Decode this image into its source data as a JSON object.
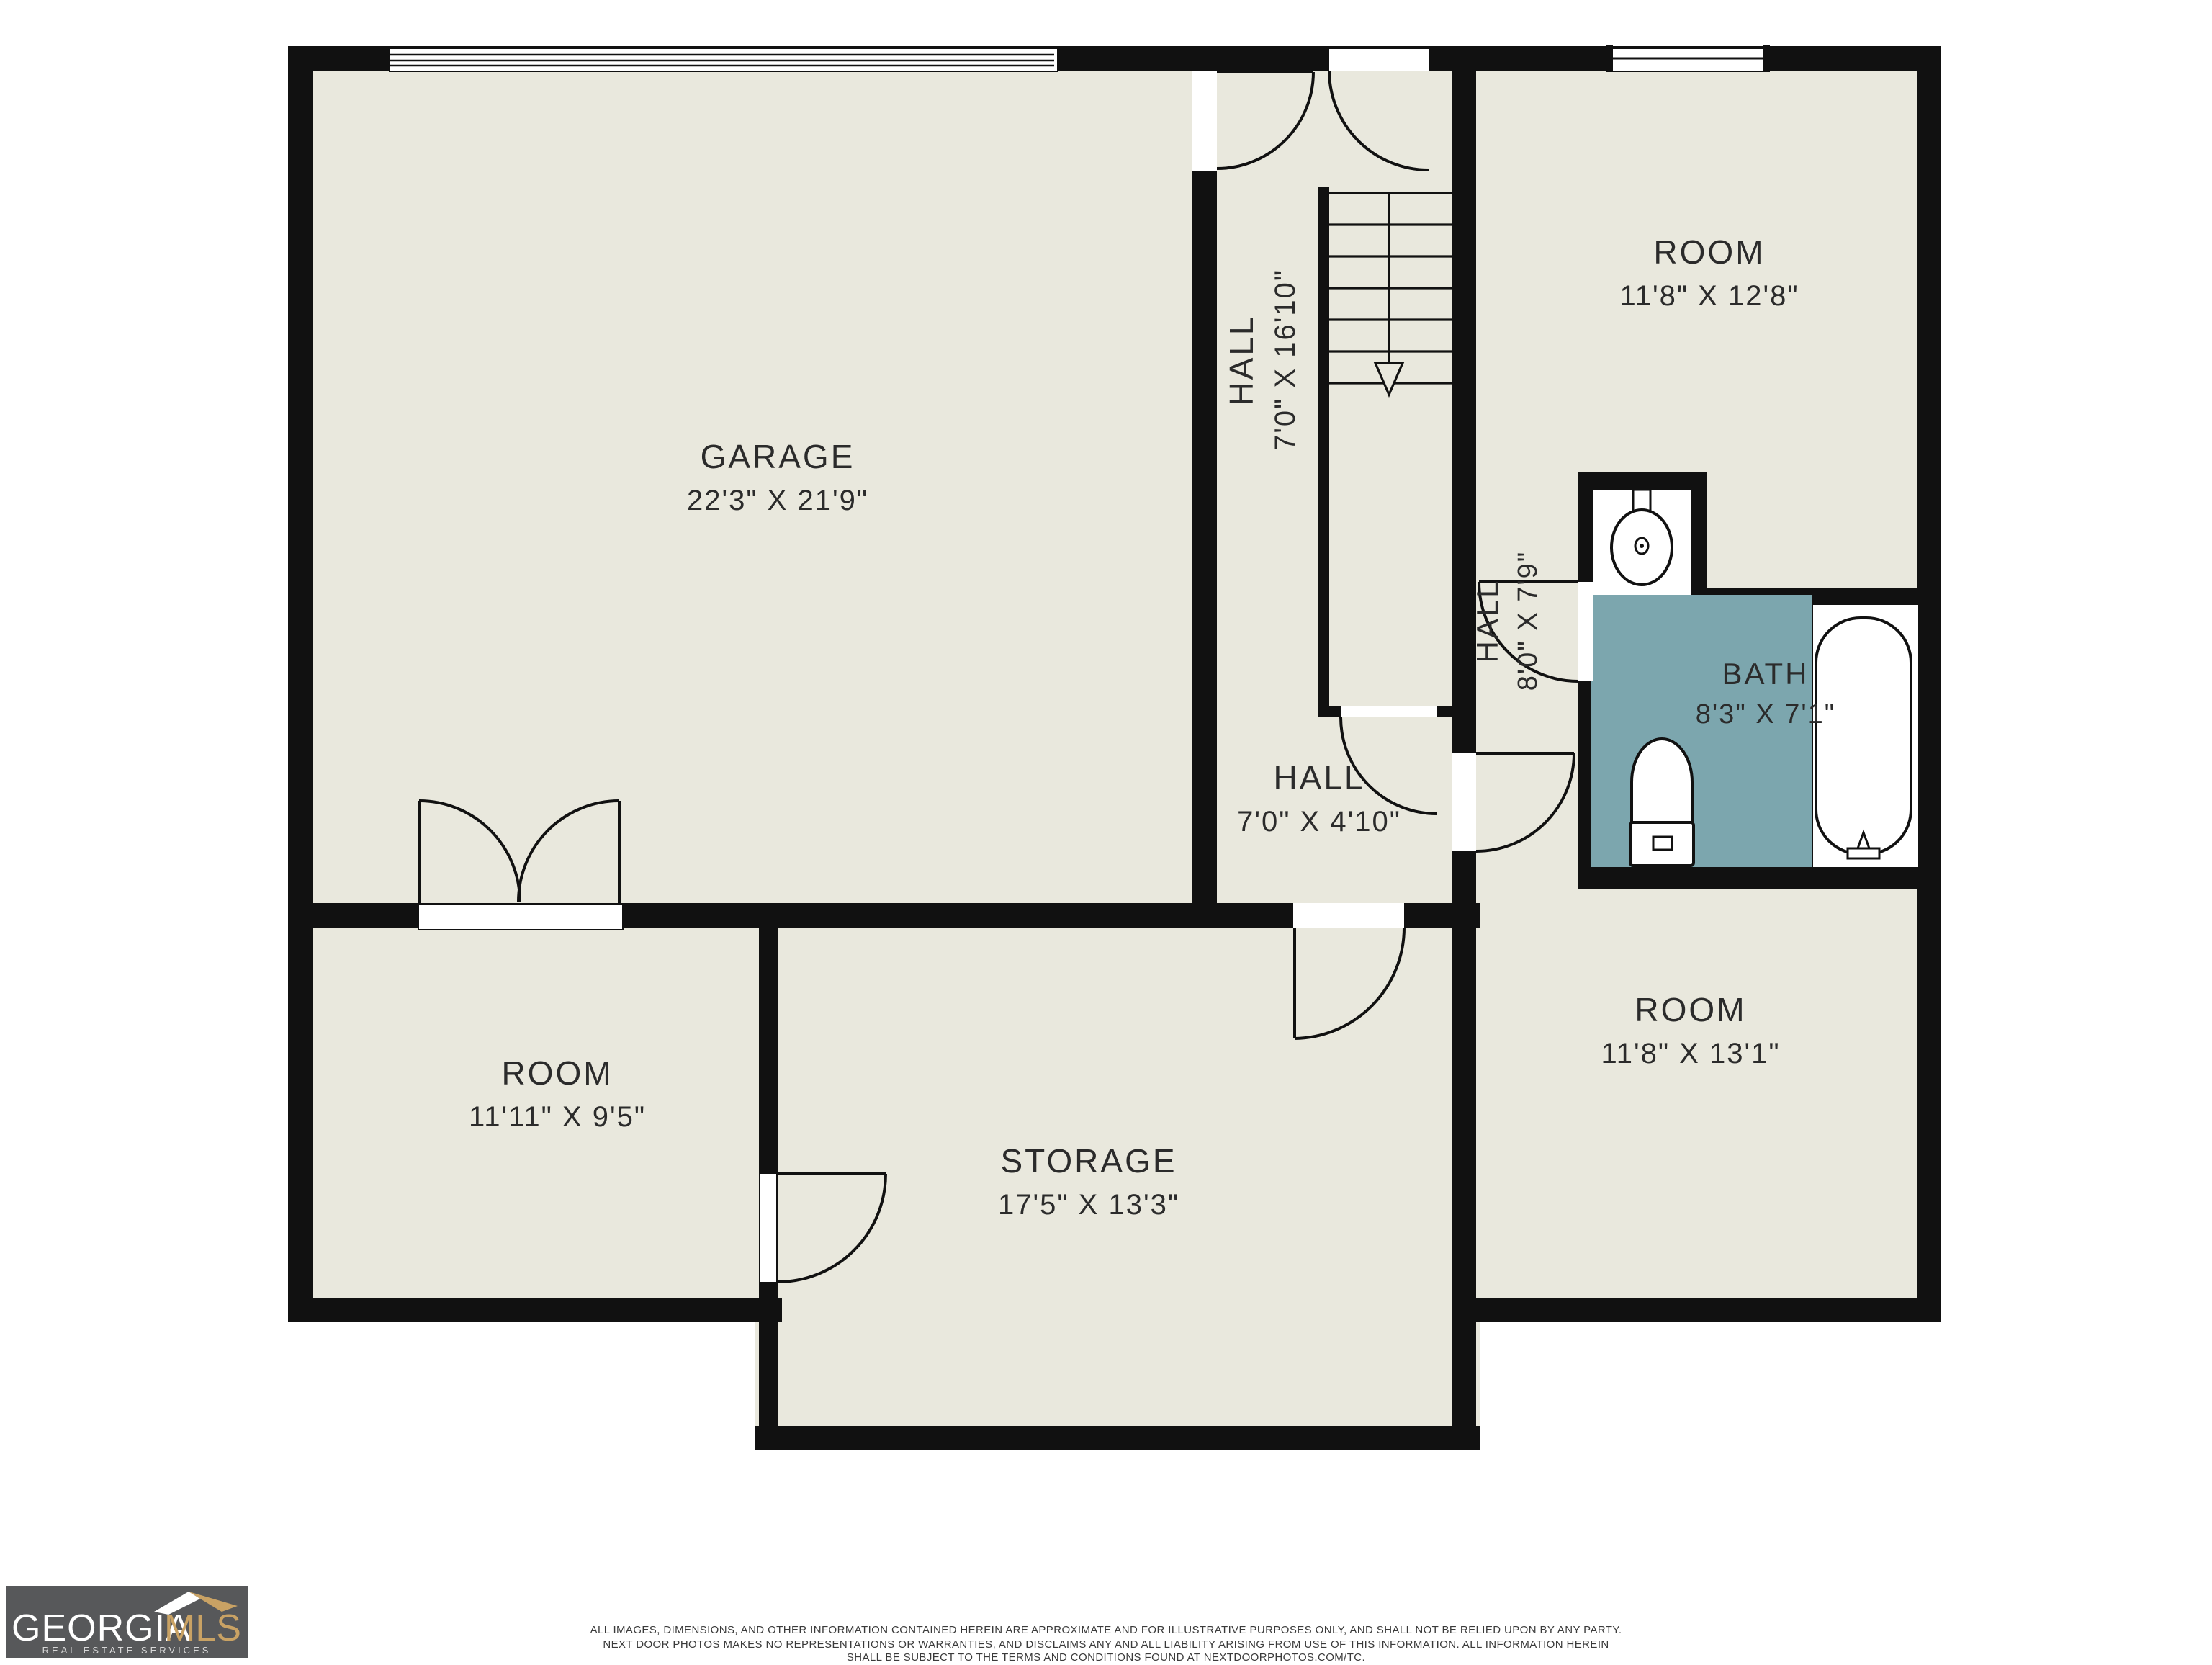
{
  "title": "Basement floor plan",
  "palette": {
    "floor": "#e9e8dd",
    "wall": "#111111",
    "bath_fill": "#7ca6ae",
    "background": "#ffffff",
    "label_text": "#2b2b2b",
    "logo_bg": "#57585a",
    "logo_primary": "#ffffff",
    "logo_accent": "#c9a264"
  },
  "rooms": [
    {
      "id": "garage",
      "name": "GARAGE",
      "dims": "22'3\" X 21'9\""
    },
    {
      "id": "hall-stairs",
      "name": "HALL",
      "dims": "7'0\" X 16'10\""
    },
    {
      "id": "room-top-right",
      "name": "ROOM",
      "dims": "11'8\" X 12'8\""
    },
    {
      "id": "hall-vestibule",
      "name": "HALL",
      "dims": "8'0\" X 7'9\""
    },
    {
      "id": "bath",
      "name": "BATH",
      "dims": "8'3\" X 7'1\""
    },
    {
      "id": "hall-lower",
      "name": "HALL",
      "dims": "7'0\" X 4'10\""
    },
    {
      "id": "room-bottom-left",
      "name": "ROOM",
      "dims": "11'11\" X 9'5\""
    },
    {
      "id": "storage",
      "name": "STORAGE",
      "dims": "17'5\" X 13'3\""
    },
    {
      "id": "room-bottom-right",
      "name": "ROOM",
      "dims": "11'8\" X 13'1\""
    }
  ],
  "fixtures": [
    "stairs-down",
    "sink",
    "toilet",
    "bathtub",
    "garage-door",
    "window",
    "door-arcs"
  ],
  "logo": {
    "name_primary": "GEORGIA",
    "name_secondary": "MLS",
    "tagline": "REAL ESTATE SERVICES"
  },
  "disclaimer": {
    "line1": "ALL IMAGES, DIMENSIONS, AND OTHER INFORMATION CONTAINED HEREIN ARE APPROXIMATE AND FOR ILLUSTRATIVE PURPOSES ONLY, AND SHALL NOT BE RELIED UPON BY ANY PARTY.",
    "line2": "NEXT DOOR PHOTOS MAKES NO REPRESENTATIONS OR WARRANTIES, AND DISCLAIMS ANY AND ALL LIABILITY ARISING FROM USE OF THIS INFORMATION. ALL INFORMATION HEREIN",
    "line3": "SHALL BE SUBJECT TO THE TERMS AND CONDITIONS FOUND AT NEXTDOORPHOTOS.COM/TC."
  }
}
